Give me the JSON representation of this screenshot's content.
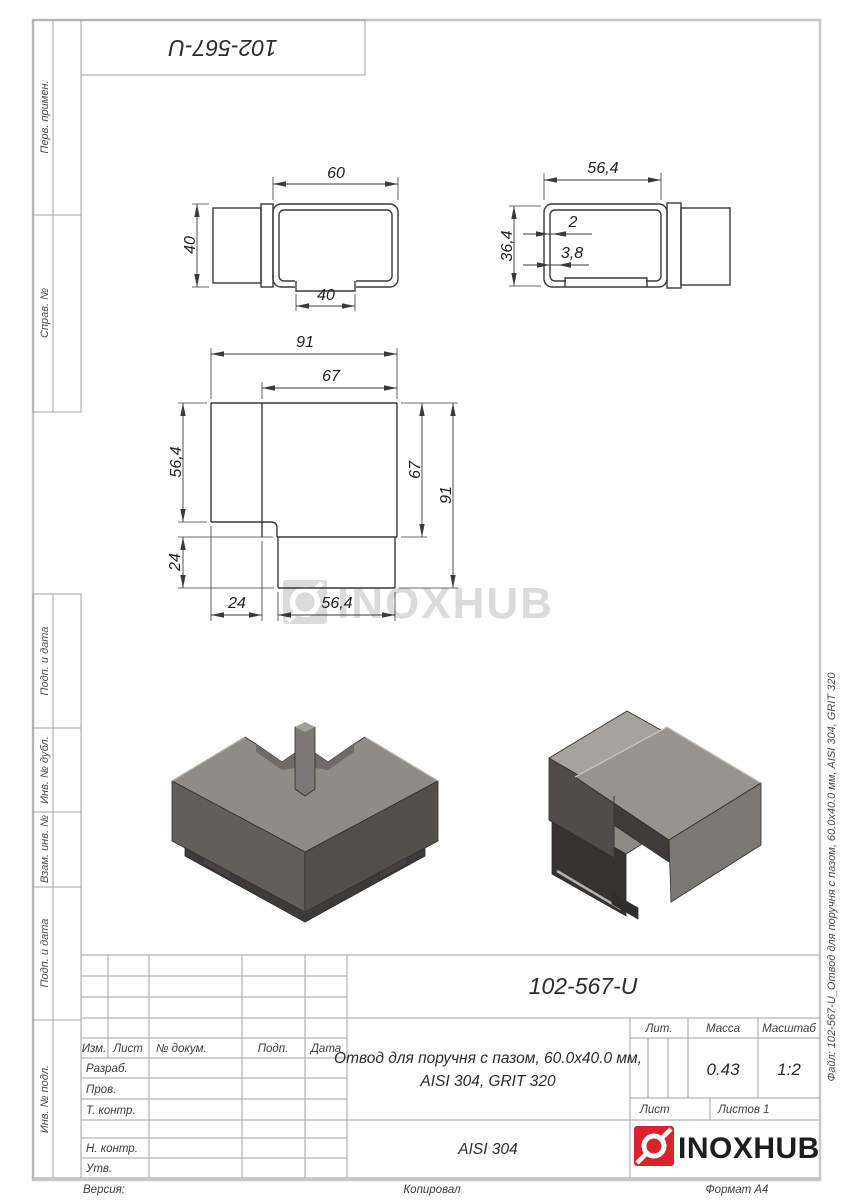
{
  "page": {
    "doc_number_top": "102-567-U",
    "file_note": "Файл: 102-567-U_Отвод для поручня с пазом, 60.0х40.0 мм, AISI 304, GRIT 320",
    "footer": {
      "version": "Версия:",
      "copied": "Копировал",
      "format": "Формат А4"
    }
  },
  "sidebar": {
    "items": [
      {
        "label": "Перв. примен."
      },
      {
        "label": "Справ. №"
      },
      {
        "label": "Подп. и дата"
      },
      {
        "label": "Инв. № дубл."
      },
      {
        "label": "Взам. инв. №"
      },
      {
        "label": "Подп. и дата"
      },
      {
        "label": "Инв. № подл."
      }
    ]
  },
  "views": {
    "front": {
      "top": "60",
      "height": "40",
      "slot": "40"
    },
    "side": {
      "top": "56,4",
      "height": "36,4",
      "wall": "2",
      "groove": "3,8"
    },
    "plan": {
      "total_w": "91",
      "inner_w": "67",
      "left_h": "56,4",
      "tab_h": "24",
      "bottom_left": "24",
      "bottom_slot": "56,4",
      "right_inner": "67",
      "right_total": "91"
    }
  },
  "watermark": {
    "text": "INOXHUB"
  },
  "title_block": {
    "rev_header": {
      "izm": "Изм.",
      "list": "Лист",
      "doc": "№ докум.",
      "podp": "Подп.",
      "data": "Дата"
    },
    "staff_rows": [
      {
        "label": "Разраб."
      },
      {
        "label": "Пров."
      },
      {
        "label": "Т. контр."
      },
      {
        "label": "Н. контр."
      },
      {
        "label": "Утв."
      }
    ],
    "part_number": "102-567-U",
    "title_line1": "Отвод для поручня с пазом, 60.0х40.0 мм,",
    "title_line2": "AISI 304, GRIT 320",
    "lit_label": "Лит.",
    "mass_label": "Масса",
    "scale_label": "Масштаб",
    "mass_value": "0.43",
    "scale_value": "1:2",
    "sheet_label": "Лист",
    "sheets_label": "Листов 1",
    "material": "AISI 304",
    "brand": "INOXHUB",
    "brand_color": "#d8232a"
  }
}
